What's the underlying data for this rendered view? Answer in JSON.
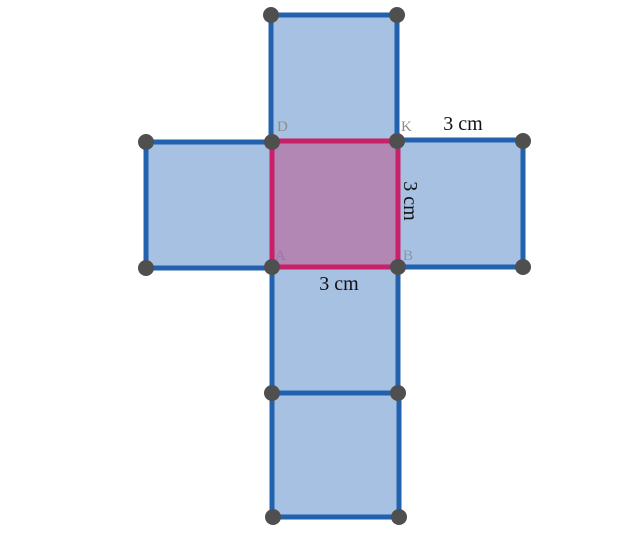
{
  "figure": {
    "description": "Cube net of six squares in a cross with highlighted center face",
    "background": "#ffffff",
    "canvas": {
      "width": 640,
      "height": 536
    },
    "colors": {
      "face_fill": "#a6c1e1",
      "face_stroke": "#2161ae",
      "center_fill": "#b287b3",
      "center_stroke": "#c92168",
      "point_fill": "#4f4f4f",
      "measure_color": "#111111"
    },
    "stroke_width": 5,
    "point_radius": 8,
    "measure_font_size": 20,
    "vertex_font_size": 15,
    "squares": [
      {
        "name": "top",
        "x": 271,
        "y": 15,
        "w": 126,
        "h": 126,
        "kind": "face"
      },
      {
        "name": "left",
        "x": 146,
        "y": 142,
        "w": 126,
        "h": 126,
        "kind": "face"
      },
      {
        "name": "right",
        "x": 398,
        "y": 140,
        "w": 125,
        "h": 127,
        "kind": "face"
      },
      {
        "name": "lower-middle",
        "x": 272,
        "y": 267,
        "w": 126,
        "h": 126,
        "kind": "face"
      },
      {
        "name": "bottom",
        "x": 272,
        "y": 393,
        "w": 127,
        "h": 124,
        "kind": "face"
      },
      {
        "name": "center",
        "x": 272,
        "y": 141,
        "w": 126,
        "h": 126,
        "kind": "center"
      }
    ],
    "points": [
      [
        271,
        15
      ],
      [
        397,
        15
      ],
      [
        146,
        142
      ],
      [
        272,
        142
      ],
      [
        397,
        141
      ],
      [
        523,
        141
      ],
      [
        146,
        268
      ],
      [
        272,
        267
      ],
      [
        398,
        267
      ],
      [
        523,
        267
      ],
      [
        272,
        393
      ],
      [
        398,
        393
      ],
      [
        273,
        517
      ],
      [
        399,
        517
      ]
    ],
    "vertex_labels": [
      {
        "text": "D",
        "x": 277,
        "y": 131,
        "color": "#8d8d8d"
      },
      {
        "text": "K",
        "x": 401,
        "y": 131,
        "color": "#8d8d8d"
      },
      {
        "text": "A",
        "x": 275,
        "y": 260,
        "color": "#8f7ba6"
      },
      {
        "text": "B",
        "x": 403,
        "y": 260,
        "color": "#8a96ad"
      }
    ],
    "measurements": [
      {
        "text": "3 cm",
        "x": 463,
        "y": 130,
        "rotation": 0
      },
      {
        "text": "3 cm",
        "x": 404,
        "y": 201,
        "rotation": 90
      },
      {
        "text": "3 cm",
        "x": 339,
        "y": 290,
        "rotation": 0
      }
    ]
  }
}
